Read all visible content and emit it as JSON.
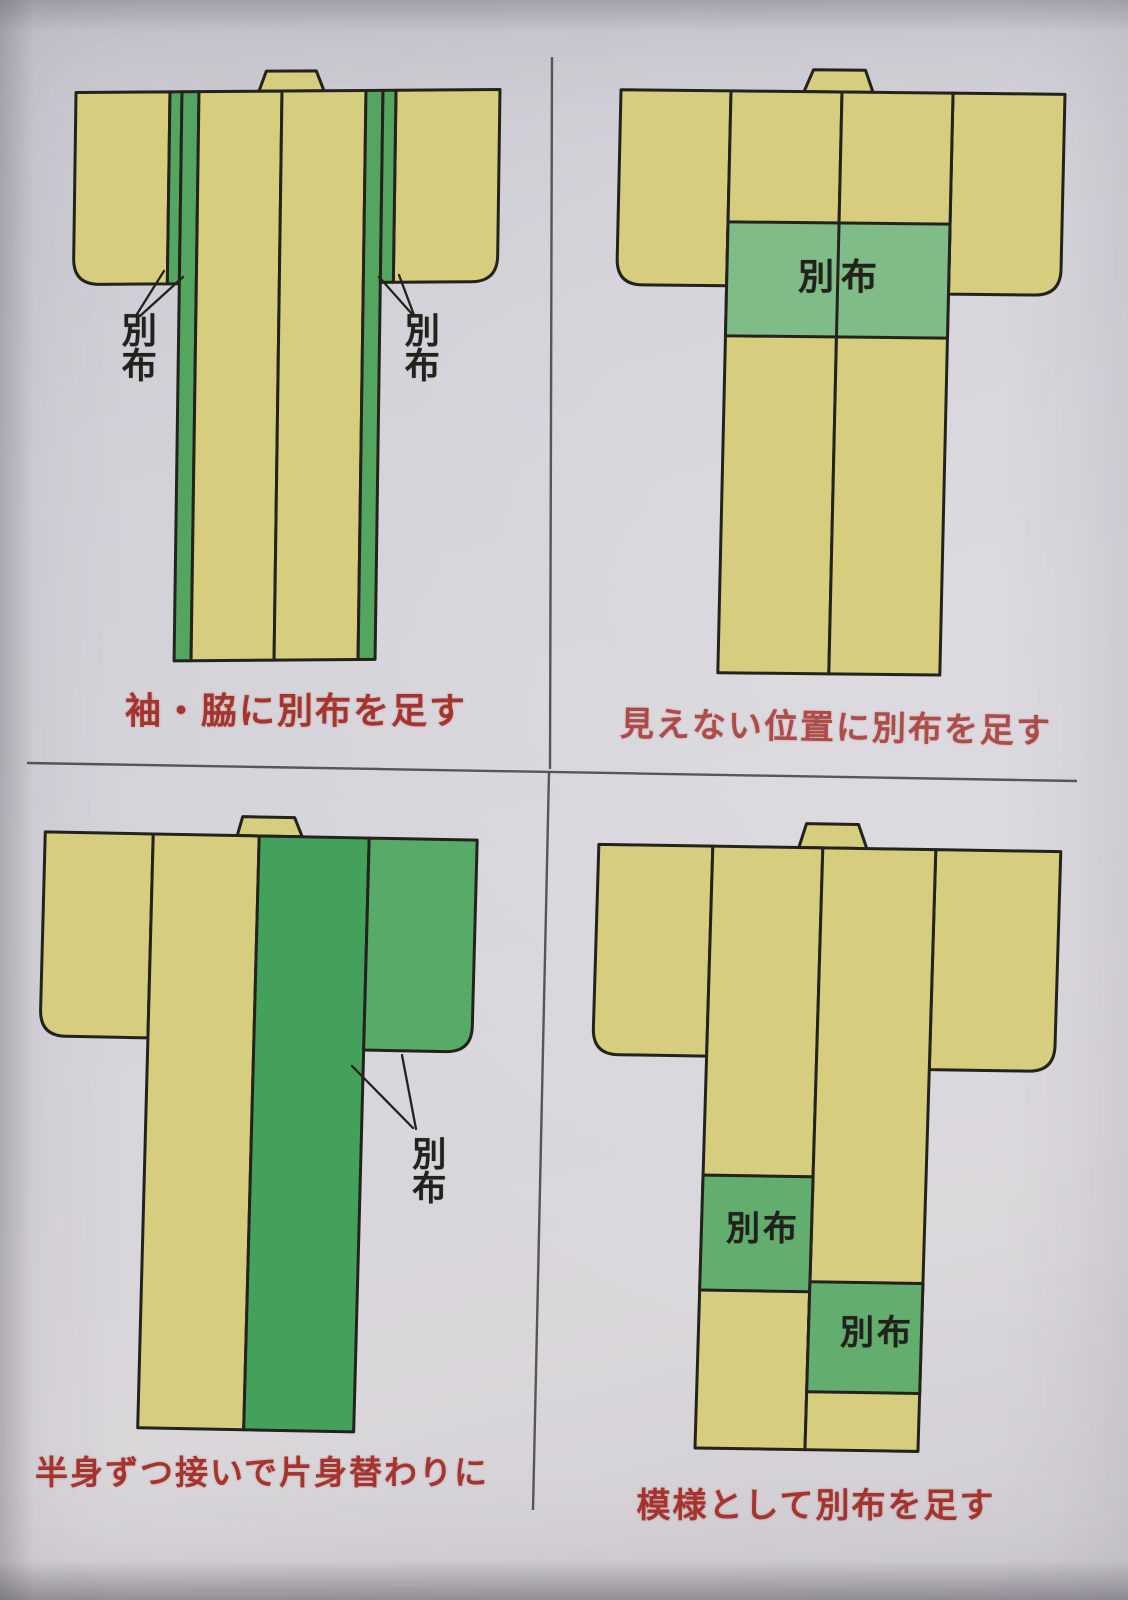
{
  "colors": {
    "paper": "#d5d3da",
    "outline": "#24221c",
    "divider": "#413f3c",
    "fabric_yellow": "#d6cd7f",
    "green_strip": "#54a55f",
    "green_band": "#7fbc88",
    "green_half_body": "#43a15c",
    "green_half_sleeve": "#57aa68",
    "green_patch": "#63ae6e",
    "caption_red": "#a5342e",
    "label_ink": "#22211c"
  },
  "quadrants": {
    "top_left": {
      "caption": "袖・脇に別布を足す",
      "labels": {
        "left": "別布",
        "right": "別布"
      }
    },
    "top_right": {
      "caption": "見えない位置に別布を足す",
      "labels": {
        "band": "別布"
      }
    },
    "bottom_left": {
      "caption": "半身ずつ接いで片身替わりに",
      "labels": {
        "side": "別布"
      }
    },
    "bottom_right": {
      "caption": "模様として別布を足す",
      "labels": {
        "upper": "別布",
        "lower": "別布"
      }
    }
  }
}
